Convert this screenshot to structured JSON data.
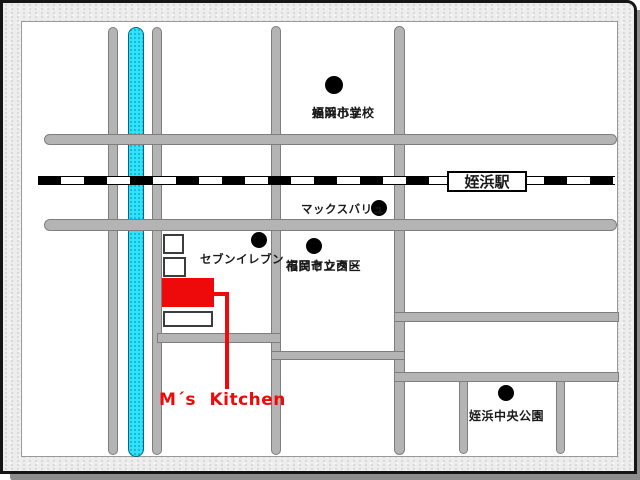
{
  "colors": {
    "road": "#b4b4b4",
    "road_border": "#7e7e7e",
    "river": "#35e1f9",
    "river_dot": "#00b9d8",
    "river_border": "#00687f",
    "rail_black": "#000000",
    "accent_red": "#ee0a0a",
    "frame_bg": "#ededed",
    "shadow": "#8d8d8d",
    "page_border": "#9a9a9a",
    "building_border": "#3c3c3c"
  },
  "station": {
    "label": "姪浜駅"
  },
  "pois": {
    "school": {
      "line1": "福岡市立",
      "line2": "姪浜小学校",
      "marker": "black-dot"
    },
    "maxvalu": {
      "label": "マックスバリュ",
      "marker": "black-dot"
    },
    "seven": {
      "label": "セブンイレブン",
      "marker": "black-dot"
    },
    "civic": {
      "line1": "福岡市立西区",
      "line2": "市民センター",
      "marker": "black-dot"
    },
    "park": {
      "label": "姪浜中央公園",
      "marker": "black-dot"
    },
    "kitchen": {
      "label": "M´s Kitchen",
      "marker": "red-building"
    }
  }
}
